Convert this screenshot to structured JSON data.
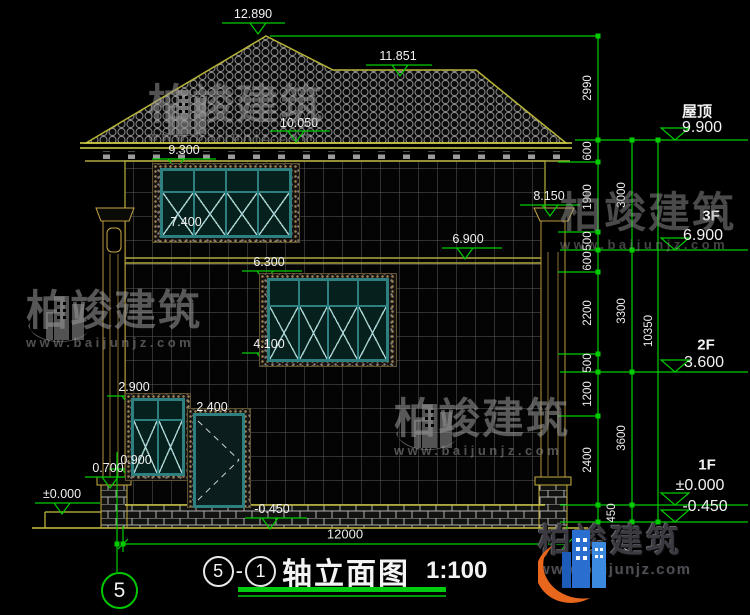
{
  "brand": {
    "name": "柏竣建筑",
    "url": "www.baijunjz.com"
  },
  "title": {
    "axis_start": "5",
    "sep": "-",
    "axis_end": "1",
    "name": "轴立面图",
    "scale": "1:100"
  },
  "axis_bubble": "5",
  "colors": {
    "dimension_green": "#00cc00",
    "line_yellow": "#b8b438",
    "window_teal": "#2e7f7f",
    "logo_blue": "#2a6fd0",
    "logo_orange": "#e8671c"
  },
  "levels": {
    "roof_label": "屋顶",
    "roof": "9.900",
    "f3_label": "3F",
    "f3": "6.900",
    "f2_label": "2F",
    "f2": "3.600",
    "f1_label": "1F",
    "f1": "±0.000",
    "below": "-0.450"
  },
  "markers": {
    "peak": "12.890",
    "ridge": "11.851",
    "upper_eave": "10.050",
    "eave": "9.300",
    "pilaster_top": "8.150",
    "f3_sill": "7.400",
    "f3_floor": "6.900",
    "f2_win_top": "6.300",
    "f2_sill": "4.100",
    "f1_win_top": "2.900",
    "door_top": "2.400",
    "f1_sill": "0.900",
    "pier_cap": "0.700",
    "ground": "±0.000",
    "plinth": "-0.450"
  },
  "dims": {
    "chain_inner": [
      "2990",
      "600",
      "1900",
      "500",
      "600",
      "2200",
      "500",
      "1200",
      "2400",
      "450"
    ],
    "chain_outer": [
      "3000",
      "3300",
      "3600",
      "450"
    ],
    "total_height": "10350",
    "total_width": "12000"
  }
}
